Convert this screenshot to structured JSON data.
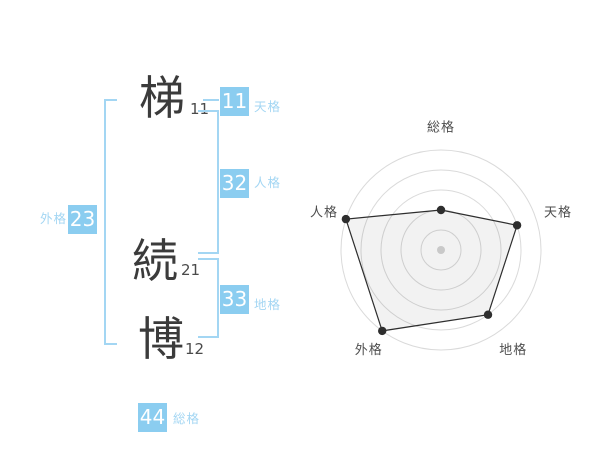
{
  "name_diagram": {
    "characters": [
      {
        "char": "梯",
        "strokes": "11"
      },
      {
        "char": "続",
        "strokes": "21"
      },
      {
        "char": "博",
        "strokes": "12"
      }
    ],
    "kaku": {
      "tenkaku": {
        "label": "天格",
        "value": "11"
      },
      "jinkaku": {
        "label": "人格",
        "value": "32"
      },
      "chikaku": {
        "label": "地格",
        "value": "33"
      },
      "gaikaku": {
        "label": "外格",
        "value": "23"
      },
      "soukaku": {
        "label": "総格",
        "value": "44"
      }
    },
    "colors": {
      "value_box": "#8bcdf0",
      "accent_text": "#a3d6f3",
      "ink": "#3b3b3b"
    }
  },
  "chart_data": {
    "type": "radar",
    "axes": [
      "総格",
      "天格",
      "地格",
      "外格",
      "人格"
    ],
    "values": [
      40,
      80,
      80,
      100,
      100
    ],
    "max": 100,
    "rings": 5,
    "center": {
      "x": 441,
      "y": 250
    },
    "radius": 100,
    "label_radius": 123,
    "grid_on": true,
    "legend": "none",
    "colors": {
      "ring": "#dadada",
      "outline": "#2e2e2e",
      "fill": "#000000",
      "fill_opacity": 0.05,
      "vertex_dot": "#2e2e2e",
      "center_dot": "#c9c9c9",
      "label": "#4d4d4d"
    }
  }
}
